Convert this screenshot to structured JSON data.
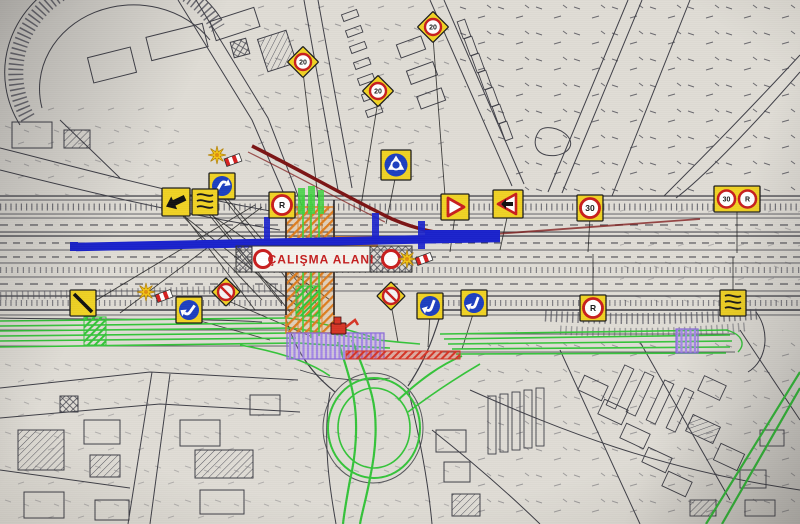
{
  "plan": {
    "work_area_label": "ÇALIŞMA ALANI"
  },
  "colors": {
    "paper": "#dfdcd5",
    "linework": "#3c3c44",
    "closure_blue": "#1a22cc",
    "detour_green": "#35c43a",
    "detour_green_bright": "#3fd13f",
    "work_zone_orange": "#dd7d1f",
    "platform_purple": "#a487e6",
    "barrier_red": "#d63526",
    "label_red": "#c42020",
    "sign_yellow": "#f0d224",
    "sign_blue": "#1d3fc0",
    "sign_ring_red": "#c81e1e",
    "detour_maroon": "#7c1414"
  },
  "signs": [
    {
      "type": "speed-diamond",
      "label": "20",
      "x": 303,
      "y": 62,
      "name": "sign-speed-limit-20-north"
    },
    {
      "type": "speed-diamond",
      "label": "20",
      "x": 378,
      "y": 91,
      "name": "sign-speed-limit-20-northeast"
    },
    {
      "type": "speed-diamond",
      "label": "20",
      "x": 433,
      "y": 27,
      "name": "sign-speed-limit-20-top"
    },
    {
      "type": "roundabout",
      "x": 396,
      "y": 165,
      "name": "sign-roundabout"
    },
    {
      "type": "mandatory-curve",
      "dir": 30,
      "x": 222,
      "y": 186,
      "name": "sign-keep-right-west"
    },
    {
      "type": "double-bend",
      "x": 205,
      "y": 202,
      "name": "sign-double-bend-west"
    },
    {
      "type": "merge-left",
      "x": 176,
      "y": 202,
      "name": "sign-lane-merge-west"
    },
    {
      "type": "flasher",
      "x": 217,
      "y": 155,
      "name": "flasher-lamp-west"
    },
    {
      "type": "barrier-flag",
      "x": 233,
      "y": 160,
      "name": "barrier-marker-west"
    },
    {
      "type": "no-parking",
      "label": "R",
      "x": 282,
      "y": 205,
      "name": "sign-no-parking-center"
    },
    {
      "type": "triangle-right",
      "x": 455,
      "y": 207,
      "name": "sign-warning-triangle-east-1"
    },
    {
      "type": "triangle-arrow",
      "x": 508,
      "y": 204,
      "name": "sign-warning-triangle-east-2"
    },
    {
      "type": "speed-square",
      "label": "30",
      "x": 590,
      "y": 208,
      "name": "sign-speed-limit-30"
    },
    {
      "type": "pair",
      "left": "30",
      "right": "R",
      "x": 737,
      "y": 199,
      "name": "sign-pair-speed-no-parking"
    },
    {
      "type": "no-parking",
      "label": "R",
      "x": 593,
      "y": 308,
      "name": "sign-no-parking-south"
    },
    {
      "type": "double-bend",
      "x": 733,
      "y": 303,
      "name": "sign-double-bend-east"
    },
    {
      "type": "no-stopping-diamond",
      "x": 391,
      "y": 296,
      "name": "sign-no-stopping-center"
    },
    {
      "type": "mandatory-curve",
      "dir": 200,
      "x": 430,
      "y": 306,
      "name": "sign-keep-left-south-1"
    },
    {
      "type": "mandatory-curve",
      "dir": 200,
      "x": 474,
      "y": 303,
      "name": "sign-keep-left-south-2"
    },
    {
      "type": "diagonal-stripe",
      "x": 83,
      "y": 303,
      "name": "sign-end-of-restriction"
    },
    {
      "type": "flasher",
      "x": 146,
      "y": 292,
      "name": "flasher-lamp-southwest"
    },
    {
      "type": "barrier-flag",
      "x": 164,
      "y": 296,
      "name": "barrier-marker-southwest"
    },
    {
      "type": "mandatory-curve",
      "dir": 215,
      "x": 189,
      "y": 310,
      "name": "sign-keep-left-west"
    },
    {
      "type": "no-stopping-diamond",
      "x": 226,
      "y": 292,
      "name": "sign-no-stopping-west"
    },
    {
      "type": "flasher",
      "x": 407,
      "y": 259,
      "name": "flasher-lamp-center"
    },
    {
      "type": "barrier-flag",
      "x": 424,
      "y": 259,
      "name": "barrier-marker-center"
    }
  ]
}
